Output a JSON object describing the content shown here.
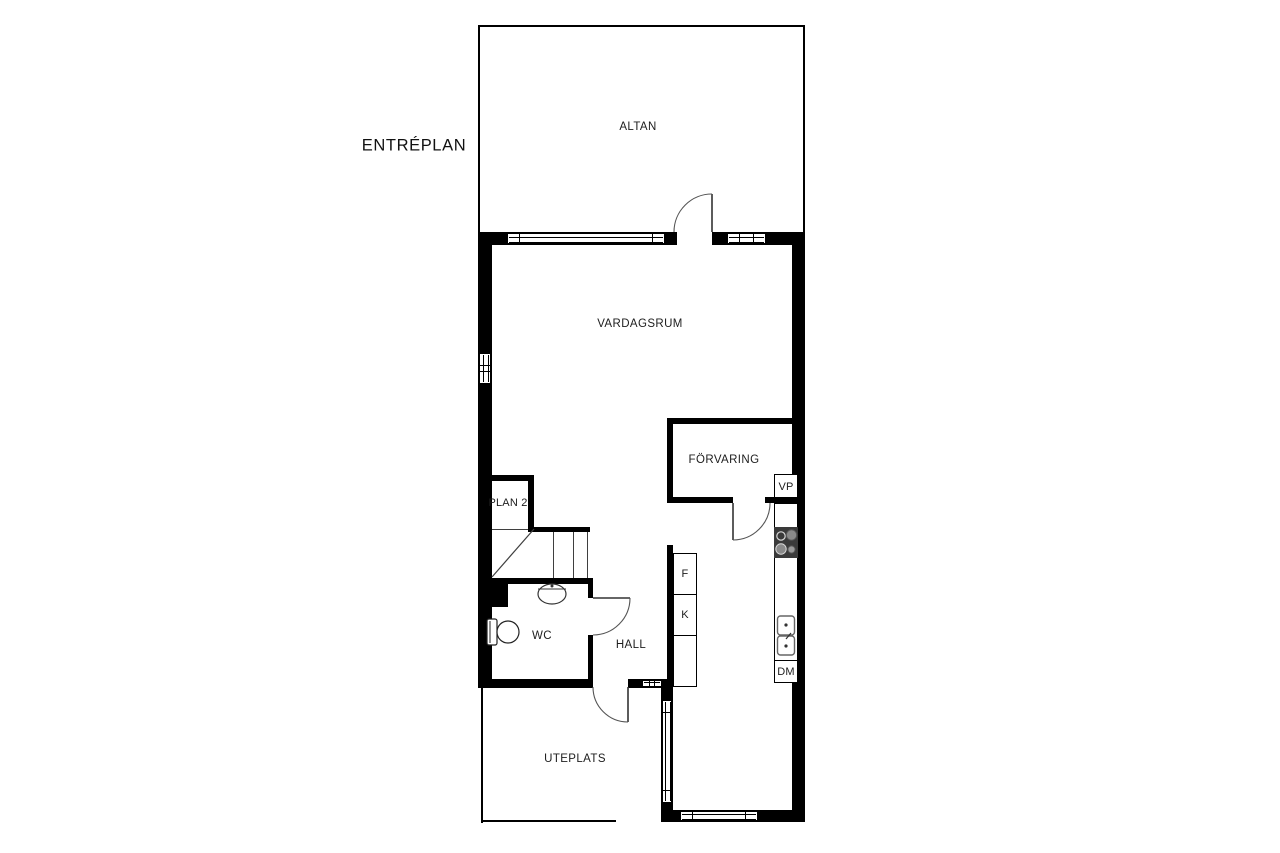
{
  "title": "ENTRÉPLAN",
  "colors": {
    "wall": "#000000",
    "line": "#444444",
    "background": "#ffffff",
    "text": "#1d1d1d",
    "stove_body": "#3a3a3a",
    "burner": "#8a8a8a"
  },
  "rooms": {
    "altan": {
      "label": "ALTAN"
    },
    "vardagsrum": {
      "label": "VARDAGSRUM"
    },
    "forvaring": {
      "label": "FÖRVARING"
    },
    "plan2": {
      "label": "PLAN 2"
    },
    "wc": {
      "label": "WC"
    },
    "hall": {
      "label": "HALL"
    },
    "uteplats": {
      "label": "UTEPLATS"
    }
  },
  "fixtures": {
    "heat_pump": {
      "label": "VP"
    },
    "freezer": {
      "label": "F"
    },
    "fridge": {
      "label": "K"
    },
    "dishwasher": {
      "label": "DM"
    }
  }
}
